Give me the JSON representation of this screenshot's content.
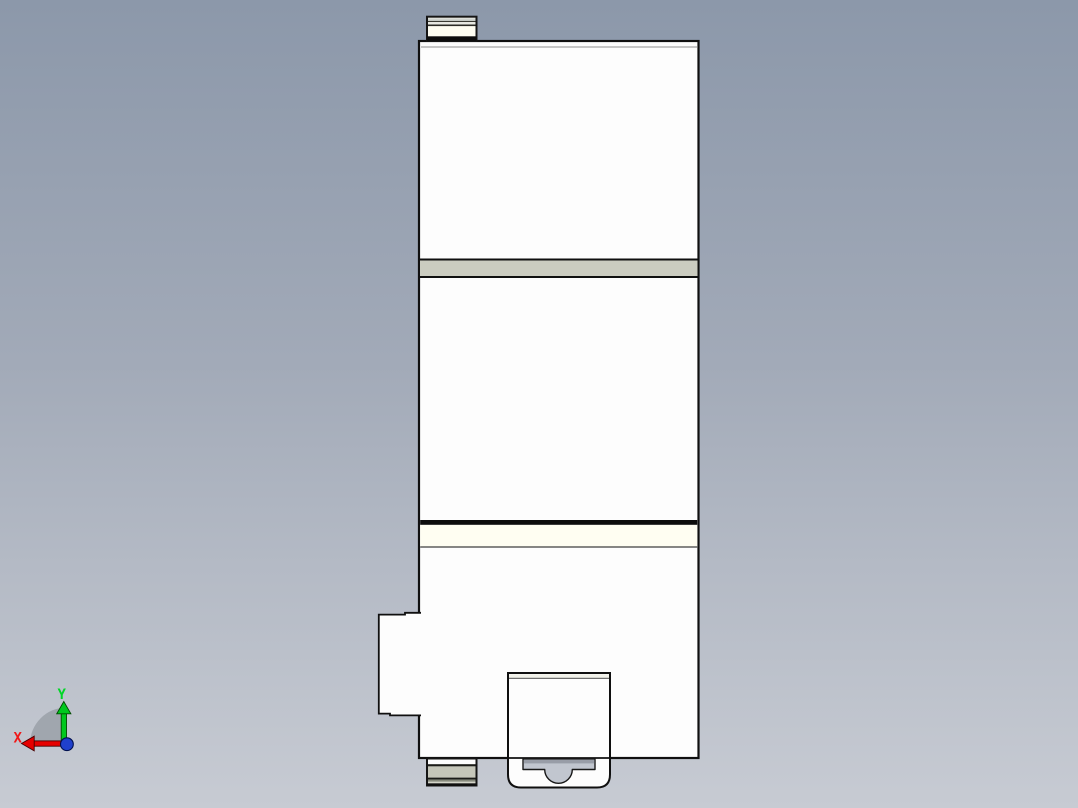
{
  "viewport": {
    "background_top": "#8c98aa",
    "background_bottom": "#c7cbd3"
  },
  "axis_triad": {
    "x_label": "X",
    "y_label": "Y",
    "x_axis_color": "#e60000",
    "x_label_color": "#f01818",
    "y_axis_color": "#00c81e",
    "y_label_color": "#00d626",
    "origin_dot_color": "#2040cc",
    "rotation_fan_color": "#9aa0a8"
  },
  "part": {
    "body_fill": "#fdfdfd",
    "outline_color": "#101010",
    "mid_band_fill": "#cbccc0",
    "label_band_fill": "#fffef2",
    "top_tab_fill": "#fffef2",
    "top_tab_stripe_light": "#d0d4cf",
    "top_tab_stripe_lighter": "#e8e9e2",
    "bottom_tab_band_fill": "#c6c7ba",
    "bottom_tab_olive_stripe": "#878a7c",
    "bottom_tab_light_stripe": "#d4d5c9",
    "connector_strip_fill": "#f2f2ea",
    "clip_cutout_fill": "#c1c6cf",
    "clip_cutout_shadow": "#989da7"
  }
}
